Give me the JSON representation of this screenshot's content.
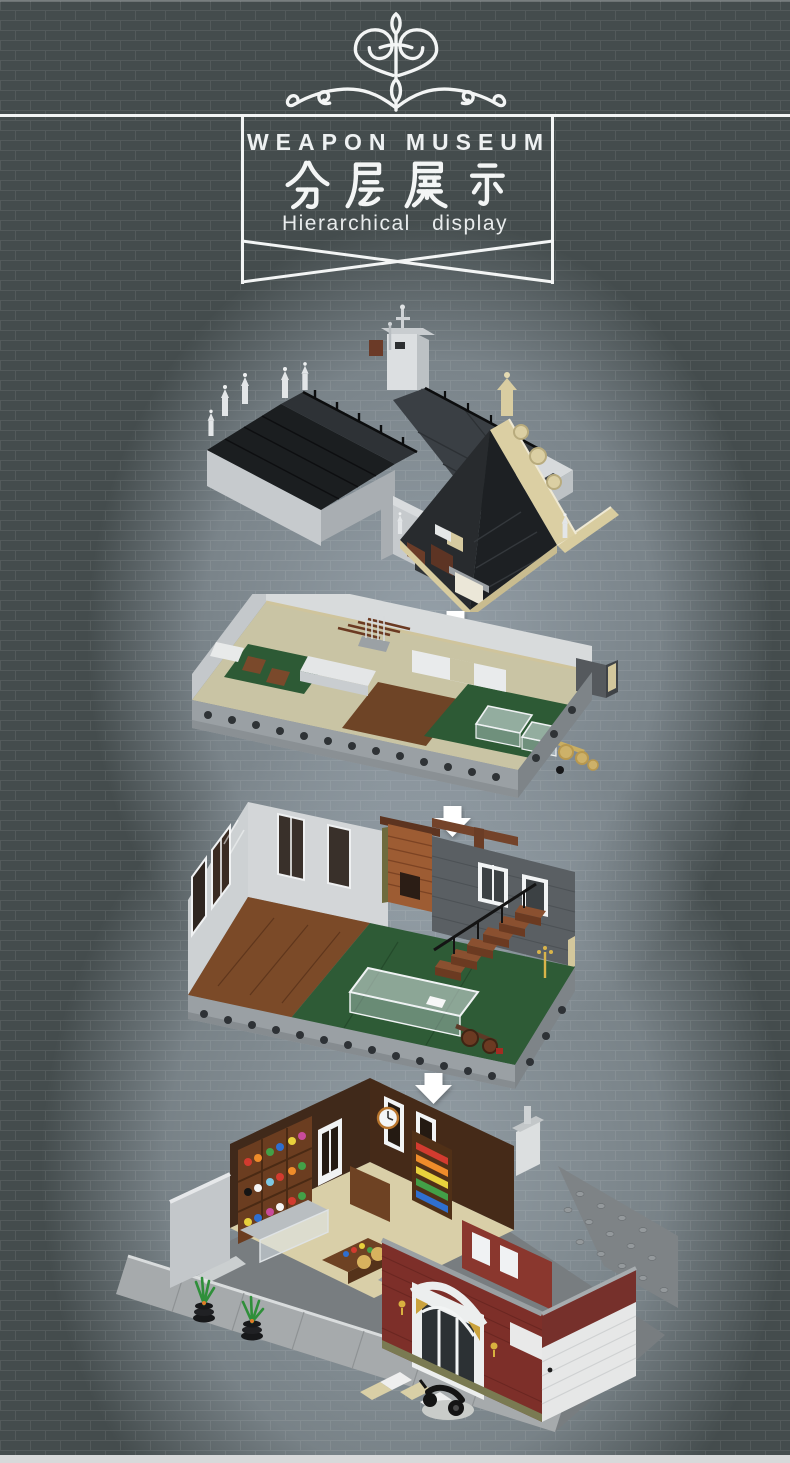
{
  "header": {
    "ornament_icon": "filigree-flourish-icon",
    "title_en": "WEAPON MUSEUM",
    "title_zh": "分层展示",
    "subtitle_en": "Hierarchical display"
  },
  "layers": [
    {
      "name": "roof-assembly",
      "alt": "Roof assembly layer: black gabled roofs with stone parapets, white pinnacles, dormer tower and tan baroque scrolled gable"
    },
    {
      "name": "top-floor",
      "alt": "Top floor interior layer: weapon workshop with rifle racks, sword stand, glass display cases and a golden cannon"
    },
    {
      "name": "middle-floor",
      "alt": "Middle floor interior layer: exhibition hall with brick fireplace, wooden staircase, long glass display case and a brown cannon"
    },
    {
      "name": "ground-floor",
      "alt": "Ground floor layer: art shop interior with colorful shelves, dark red brick facade with white arched entrance, street base plate, potted plants and a black scooter"
    }
  ],
  "separator": {
    "arrow_icon": "down-arrow-icon",
    "count": 3
  },
  "colors": {
    "background_dark": "#444c4d",
    "background_light": "#9aa5ad",
    "line_white": "#f3f5f5",
    "roof_black": "#1d2022",
    "stone_gray": "#c7cbce",
    "ornament_tan": "#dbcfa3",
    "facade_red": "#7d2f29",
    "floor_green": "#2e5b36",
    "wood_brown": "#6e4223",
    "arrow_white": "#ffffff",
    "footer_strip": "#d8d9da"
  }
}
